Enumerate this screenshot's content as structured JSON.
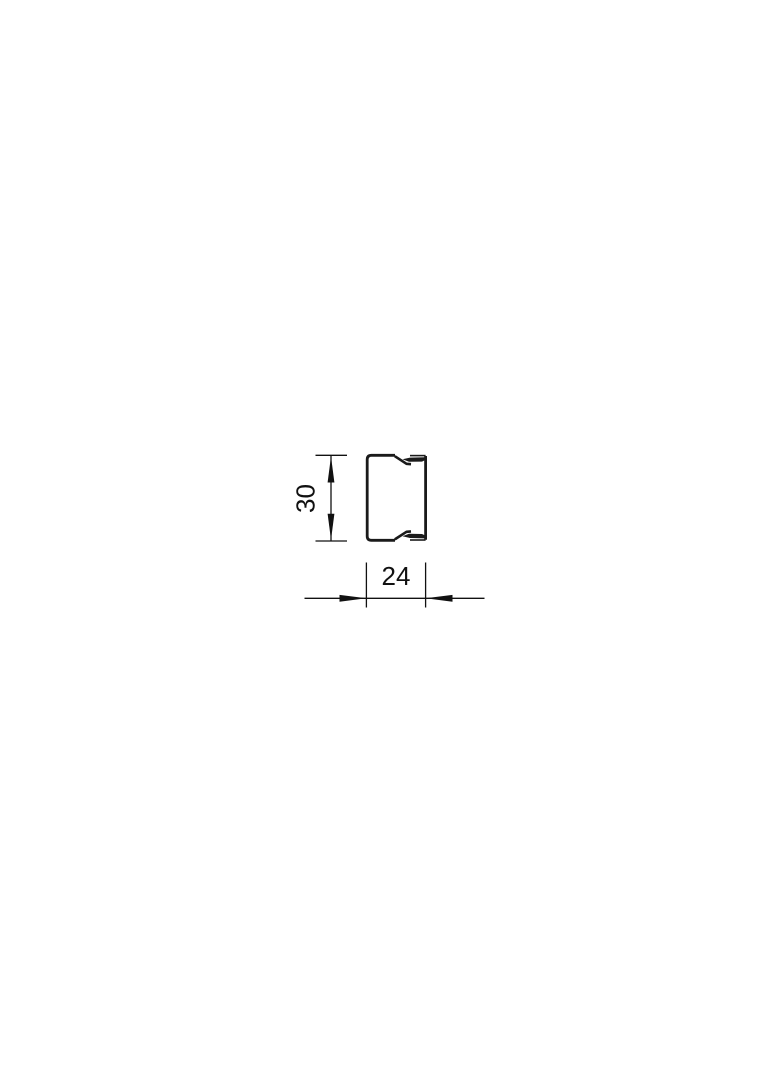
{
  "figure": {
    "height_dimension": {
      "label": "30"
    },
    "width_dimension": {
      "label": "24"
    }
  },
  "colors": {
    "line": "#1a1a1a",
    "dimension": "#111111",
    "background": "#ffffff"
  }
}
